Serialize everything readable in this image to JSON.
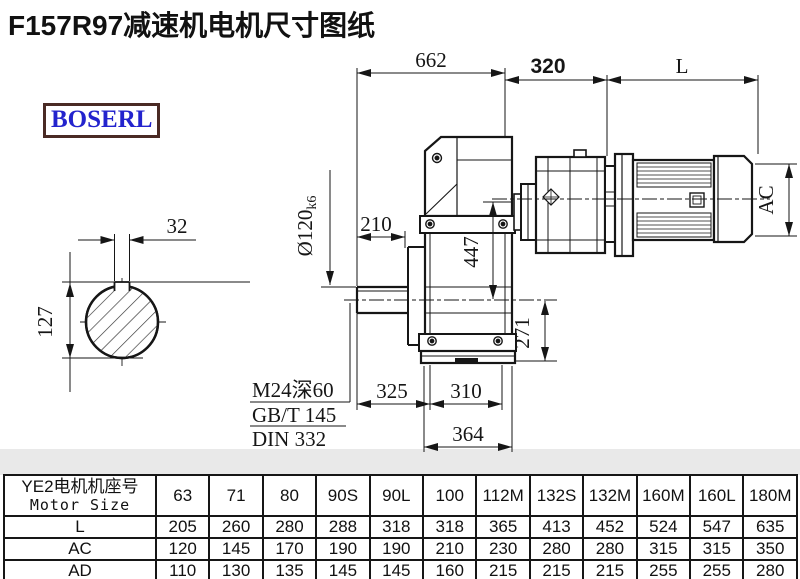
{
  "title": "F157R97减速机电机尺寸图纸",
  "logo": "BOSERL",
  "drawing": {
    "top_dims": {
      "overall": "662",
      "input_section": "320",
      "motor_length": "L"
    },
    "left_view": {
      "keyway_width": "32",
      "keyway_height": "127"
    },
    "front_view": {
      "shaft_ext": "210",
      "shaft_dia": "Ø120",
      "shaft_fit": "k6",
      "axis_offset": "447",
      "base_height": "271",
      "foot_left": "325",
      "foot_right": "310",
      "foot_width": "364"
    },
    "side_view": {
      "motor_dia": "AC"
    },
    "note": {
      "line1": "M24深60",
      "line2": "GB/T 145",
      "line3": "DIN 332"
    }
  },
  "table": {
    "row_header_cn": "YE2电机机座号",
    "row_header_en": "Motor Size",
    "columns": [
      "63",
      "71",
      "80",
      "90S",
      "90L",
      "100",
      "112M",
      "132S",
      "132M",
      "160M",
      "160L",
      "180M"
    ],
    "rows": [
      {
        "label": "L",
        "values": [
          "205",
          "260",
          "280",
          "288",
          "318",
          "318",
          "365",
          "413",
          "452",
          "524",
          "547",
          "635"
        ]
      },
      {
        "label": "AC",
        "values": [
          "120",
          "145",
          "170",
          "190",
          "190",
          "210",
          "230",
          "280",
          "280",
          "315",
          "315",
          "350"
        ]
      },
      {
        "label": "AD",
        "values": [
          "110",
          "130",
          "135",
          "145",
          "145",
          "160",
          "215",
          "215",
          "215",
          "255",
          "255",
          "280"
        ]
      }
    ]
  }
}
